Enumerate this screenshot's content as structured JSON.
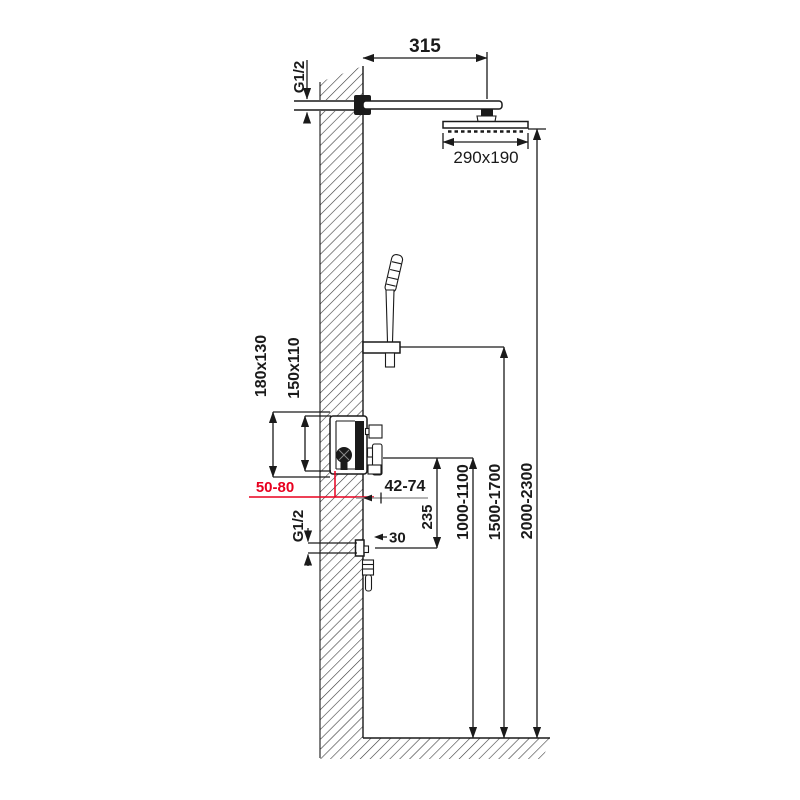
{
  "diagram": {
    "type": "shower-system-installation-drawing",
    "labels": {
      "arm_length": "315",
      "head_size": "290x190",
      "inlet_thread": "G1/2",
      "box_outer_size": "180x130",
      "box_cutout_size": "150x110",
      "embed_depth_range": "50-80",
      "trim_depth_range": "42-74",
      "outlet_offset": "235",
      "outlet_thread": "G1/2",
      "outlet_projection": "30",
      "mixer_height_range": "1000-1100",
      "handshower_height_range": "1500-1700",
      "headshower_height_range": "2000-2300"
    },
    "colors": {
      "line": "#1a1a1a",
      "red": "#e8001f",
      "gray": "#9a9a9a",
      "bg": "#ffffff"
    }
  }
}
